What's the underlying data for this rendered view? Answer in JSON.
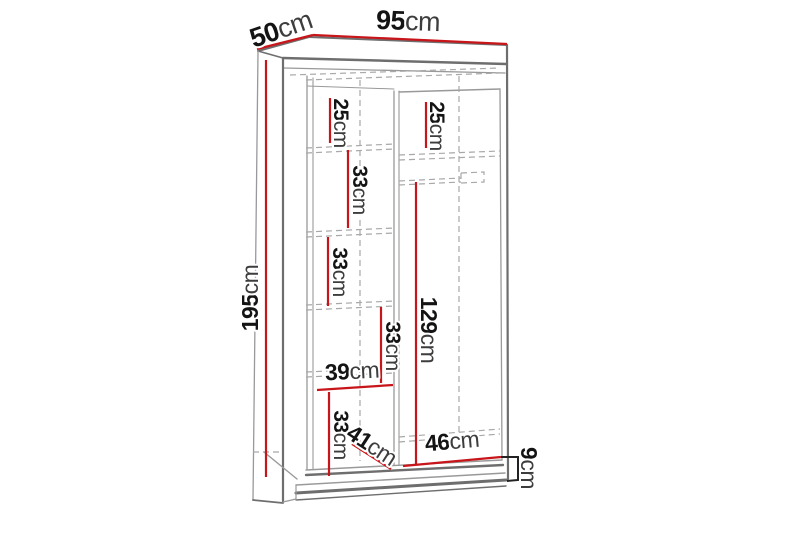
{
  "page": {
    "background": "#ffffff"
  },
  "colors": {
    "dimension_red": "#c8151a",
    "outline_gray": "#6e6e6e",
    "outline_light_gray": "#999999",
    "dashed_gray": "#a8a8a8",
    "number_black": "#141414",
    "unit_gray": "#3d3d3d"
  },
  "diagram": {
    "kind": "wardrobe-dimension-drawing",
    "unit": "cm",
    "dimensions": [
      {
        "id": "top-width",
        "value": "95",
        "unit": "cm"
      },
      {
        "id": "top-depth",
        "value": "50",
        "unit": "cm"
      },
      {
        "id": "overall-height",
        "value": "195",
        "unit": "cm"
      },
      {
        "id": "left-top-section",
        "value": "25",
        "unit": "cm"
      },
      {
        "id": "right-top-section",
        "value": "25",
        "unit": "cm"
      },
      {
        "id": "left-shelf-gap-1",
        "value": "33",
        "unit": "cm"
      },
      {
        "id": "left-shelf-gap-2",
        "value": "33",
        "unit": "cm"
      },
      {
        "id": "left-shelf-gap-3",
        "value": "33",
        "unit": "cm"
      },
      {
        "id": "left-column-width",
        "value": "39",
        "unit": "cm"
      },
      {
        "id": "left-shelf-gap-4",
        "value": "33",
        "unit": "cm"
      },
      {
        "id": "interior-depth",
        "value": "41",
        "unit": "cm"
      },
      {
        "id": "hanging-space-height",
        "value": "129",
        "unit": "cm"
      },
      {
        "id": "right-column-width",
        "value": "46",
        "unit": "cm"
      },
      {
        "id": "plinth-height",
        "value": "9",
        "unit": "cm"
      }
    ]
  }
}
